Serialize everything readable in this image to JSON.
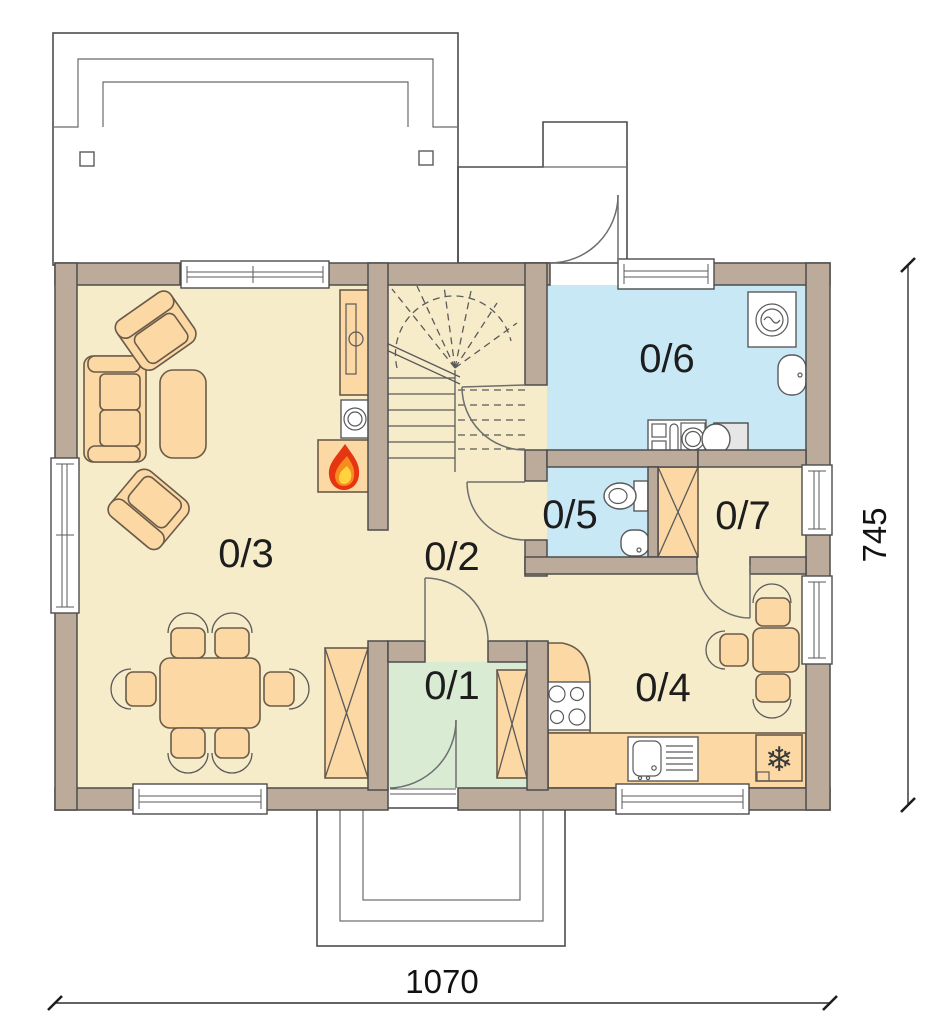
{
  "rooms": [
    {
      "label": "0/1"
    },
    {
      "label": "0/2"
    },
    {
      "label": "0/3"
    },
    {
      "label": "0/4"
    },
    {
      "label": "0/5"
    },
    {
      "label": "0/6"
    },
    {
      "label": "0/7"
    }
  ],
  "dimensions": {
    "bottom": "1070",
    "right": "745"
  },
  "symbols": {
    "fridge": "❄"
  },
  "colors": {
    "floor": "#f7ecca",
    "bathroom": "#c9e8f5",
    "entry": "#d9ecd3",
    "outdoor": "#e9ebed",
    "wall": "#bcab9b",
    "furniture": "#fbd8a4",
    "flame_red": "#e63611",
    "flame_orange": "#f68b1f",
    "flame_yellow": "#ffd23e"
  }
}
